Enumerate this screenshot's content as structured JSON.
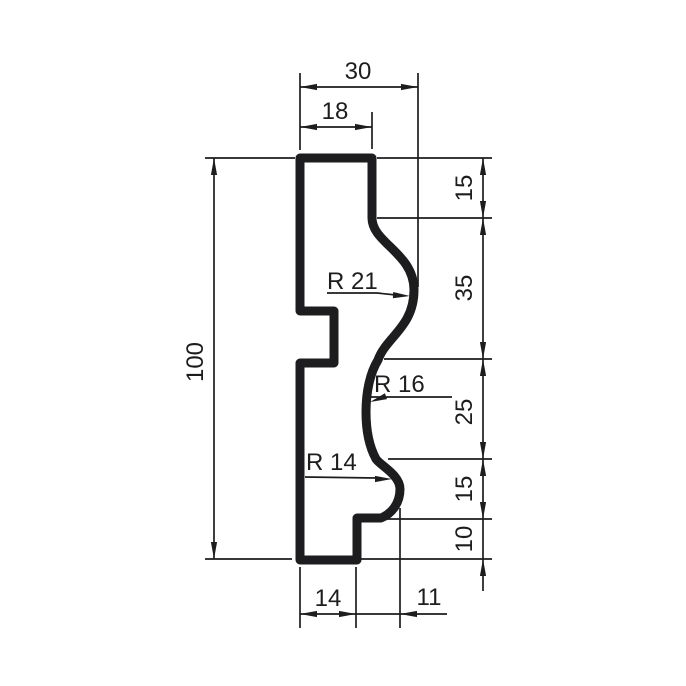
{
  "drawing": {
    "ink_color": "#1d1d1f",
    "background_color": "#ffffff",
    "dimensions": {
      "overall_width": "30",
      "top_face_width": "18",
      "right_segments": {
        "top": "15",
        "ogee": "35",
        "cove": "25",
        "lower_bulge": "15",
        "base": "10"
      },
      "overall_height": "100",
      "bottom_face_width": "14",
      "bulge_offset": "11",
      "radius_top": "R 21",
      "radius_middle": "R 16",
      "radius_bottom": "R 14"
    }
  }
}
